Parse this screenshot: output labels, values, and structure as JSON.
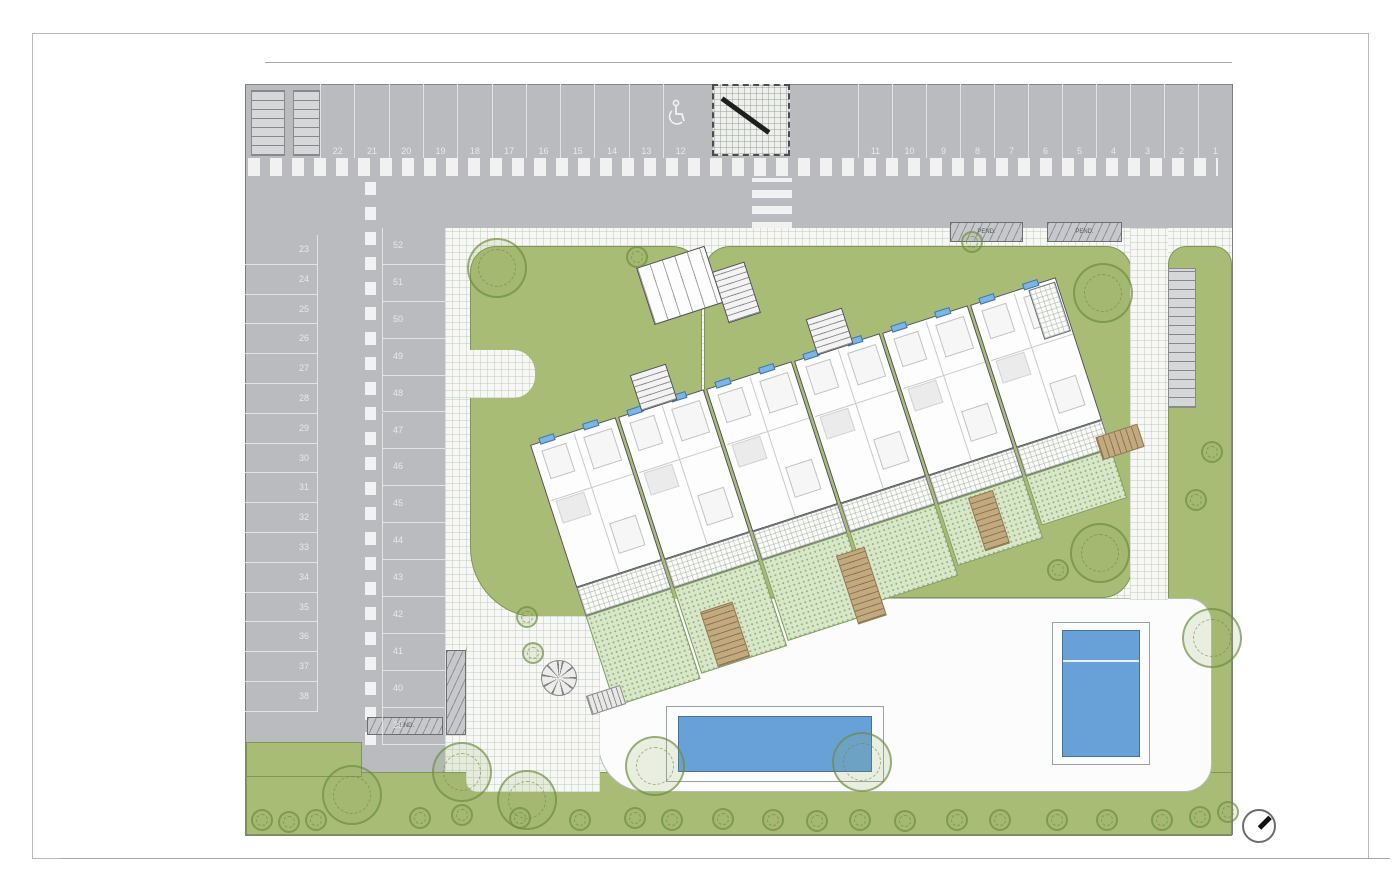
{
  "drawing": {
    "type": "residential site plan",
    "building_units": 6,
    "pools": 2
  },
  "parking": {
    "top_row_left_labels": [
      "22",
      "21",
      "20",
      "19",
      "18",
      "17",
      "16",
      "15",
      "14",
      "13",
      "12"
    ],
    "top_row_right_labels": [
      "11",
      "10",
      "9",
      "8",
      "7",
      "6",
      "5",
      "4",
      "3",
      "2",
      "1"
    ],
    "left_column_labels": [
      "23",
      "24",
      "25",
      "26",
      "27",
      "28",
      "29",
      "30",
      "31",
      "32",
      "33",
      "34",
      "35",
      "36",
      "37",
      "38"
    ],
    "middle_column_labels": [
      "52",
      "51",
      "50",
      "49",
      "48",
      "47",
      "46",
      "45",
      "44",
      "43",
      "42",
      "41",
      "40",
      "39"
    ],
    "accessible_space": "12"
  },
  "labels": {
    "ramp": "PEND."
  },
  "icons": {
    "accessible": "wheelchair-icon",
    "north": "north-arrow-icon"
  },
  "colors": {
    "road": "#babbbe",
    "lawn": "#a8bc75",
    "garden_terrace": "#d8e6c9",
    "pool": "#68a1d8",
    "paving": "#f7f8f5",
    "walkway": "#c3a97e",
    "window_marker": "#7cb4e4"
  }
}
